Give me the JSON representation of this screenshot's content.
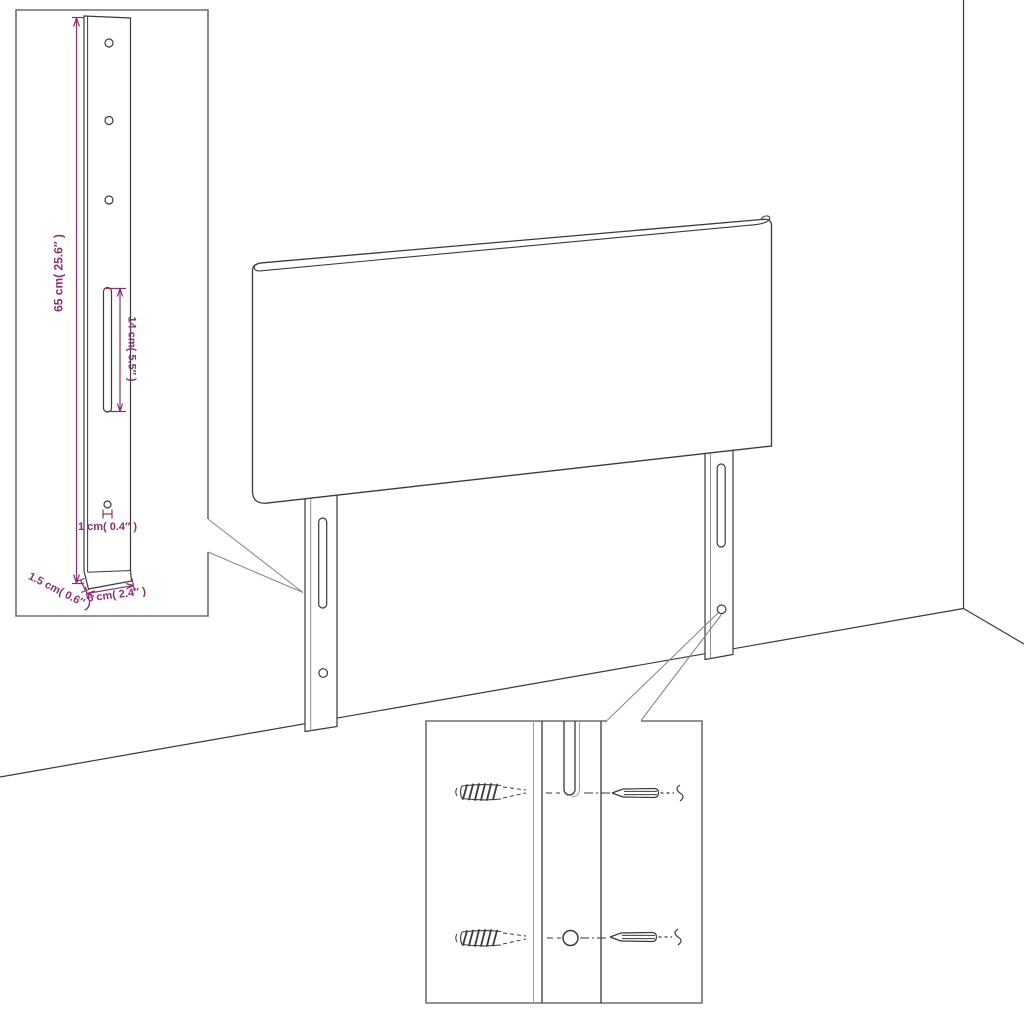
{
  "page": {
    "background": "#ffffff",
    "description": "Line-art product dimension diagram of an upholstered headboard with two mounting legs, a zoomed leg-detail inset with measurements, and a zoomed wall-mounting hardware inset showing wall plugs and screws."
  },
  "colors": {
    "dimension_accent": "#863173",
    "line_art": "#3a3a3a",
    "secondary_line": "#8f8f8f",
    "inset_border": "#6e6e6e"
  },
  "headboard_diagram": {
    "subject": "headboard-with-mounting-legs",
    "leg_detail_inset": {
      "leg_height_label": "65 cm( 25.6″ )",
      "slot_length_label": "14 cm( 5.5″ )",
      "hole_diameter_label": "1 cm( 0.4″ )",
      "leg_depth_label": "1.5 cm( 0.6″ )",
      "leg_width_label": "6 cm( 2.4″ )"
    },
    "mounting_detail_inset": {
      "icons": [
        "wall-plug-icon",
        "screw-icon",
        "leg-slot",
        "leg-hole"
      ]
    }
  }
}
